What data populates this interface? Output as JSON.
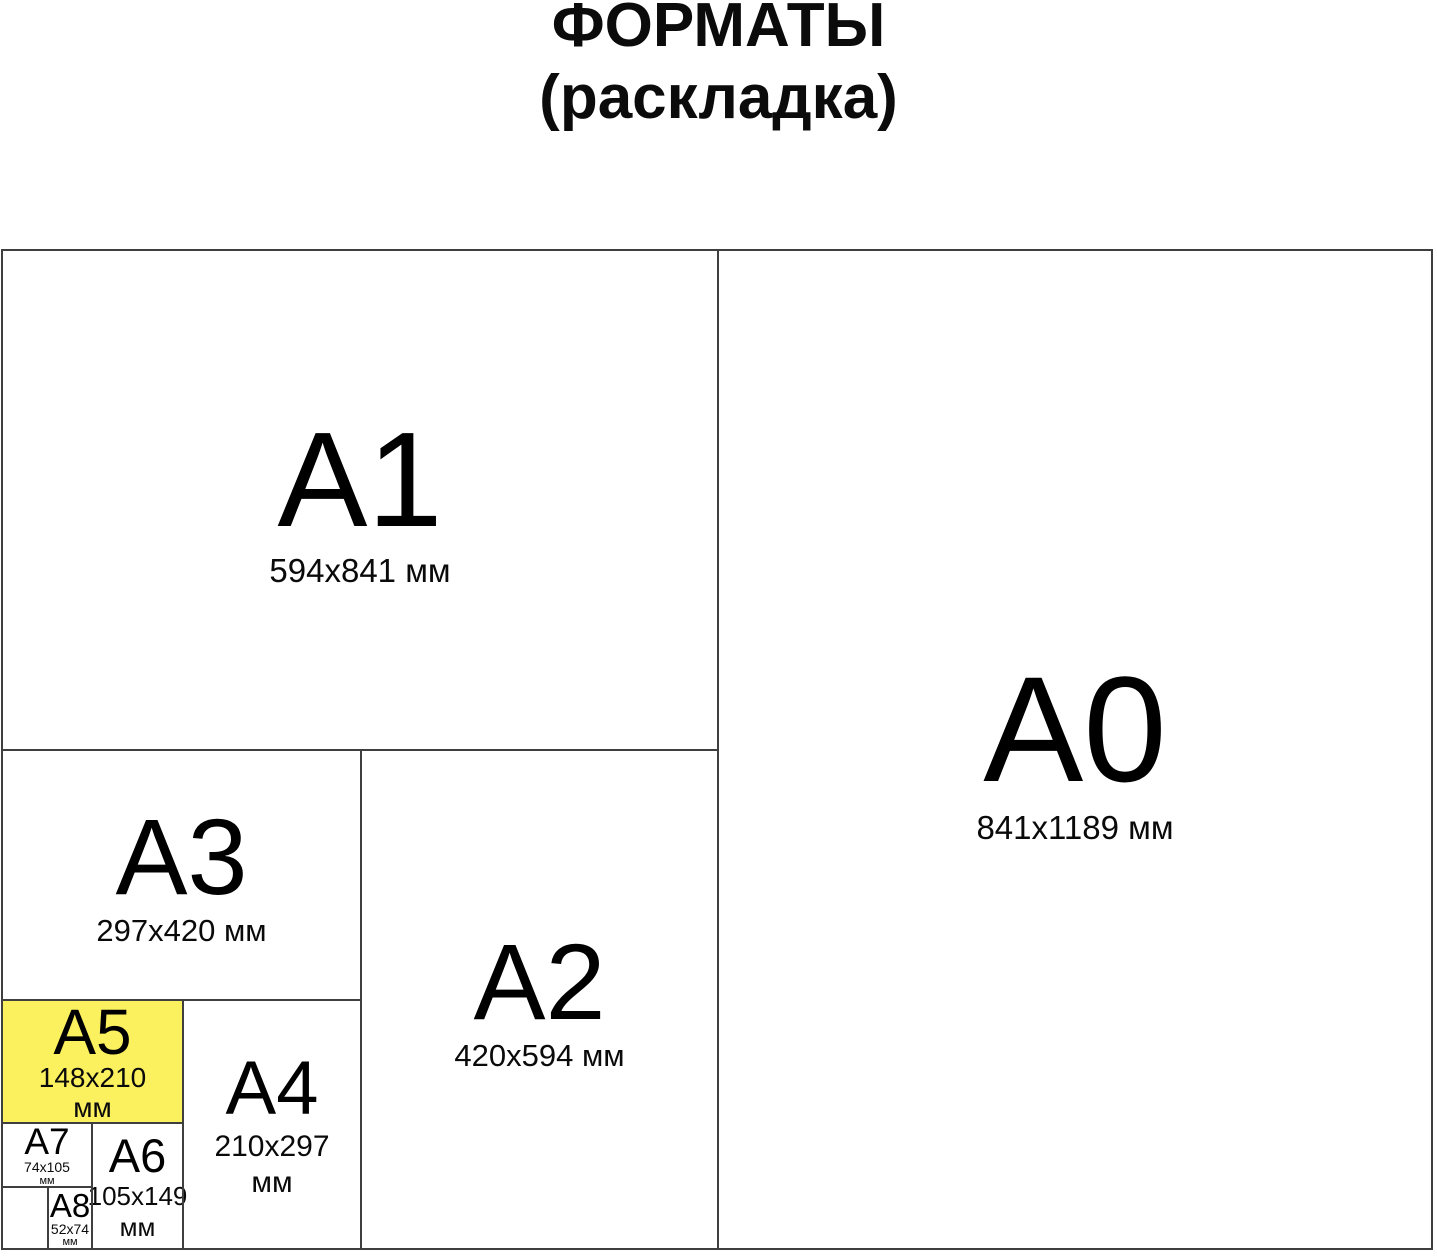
{
  "title": {
    "line1": "ФОРМАТЫ",
    "line2": "(раскладка)"
  },
  "colors": {
    "highlight_yellow": "#FBF05E",
    "line_gray": "#3f3f3f",
    "text_black": "#000000"
  },
  "formats": {
    "a0": {
      "name": "A0",
      "size": "841x1189 мм"
    },
    "a1": {
      "name": "A1",
      "size": "594x841 мм"
    },
    "a2": {
      "name": "A2",
      "size": "420x594 мм"
    },
    "a3": {
      "name": "A3",
      "size": "297x420 мм"
    },
    "a4": {
      "name": "A4",
      "size_line1": "210x297",
      "size_line2": "мм"
    },
    "a5": {
      "name": "A5",
      "size_line1": "148x210",
      "size_line2": "мм"
    },
    "a6": {
      "name": "A6",
      "size_line1": "105x149",
      "size_line2": "мм"
    },
    "a7": {
      "name": "A7",
      "size_line1": "74x105",
      "size_line2": "мм"
    },
    "a8": {
      "name": "A8",
      "size_line1": "52x74",
      "size_line2": "мм"
    }
  }
}
